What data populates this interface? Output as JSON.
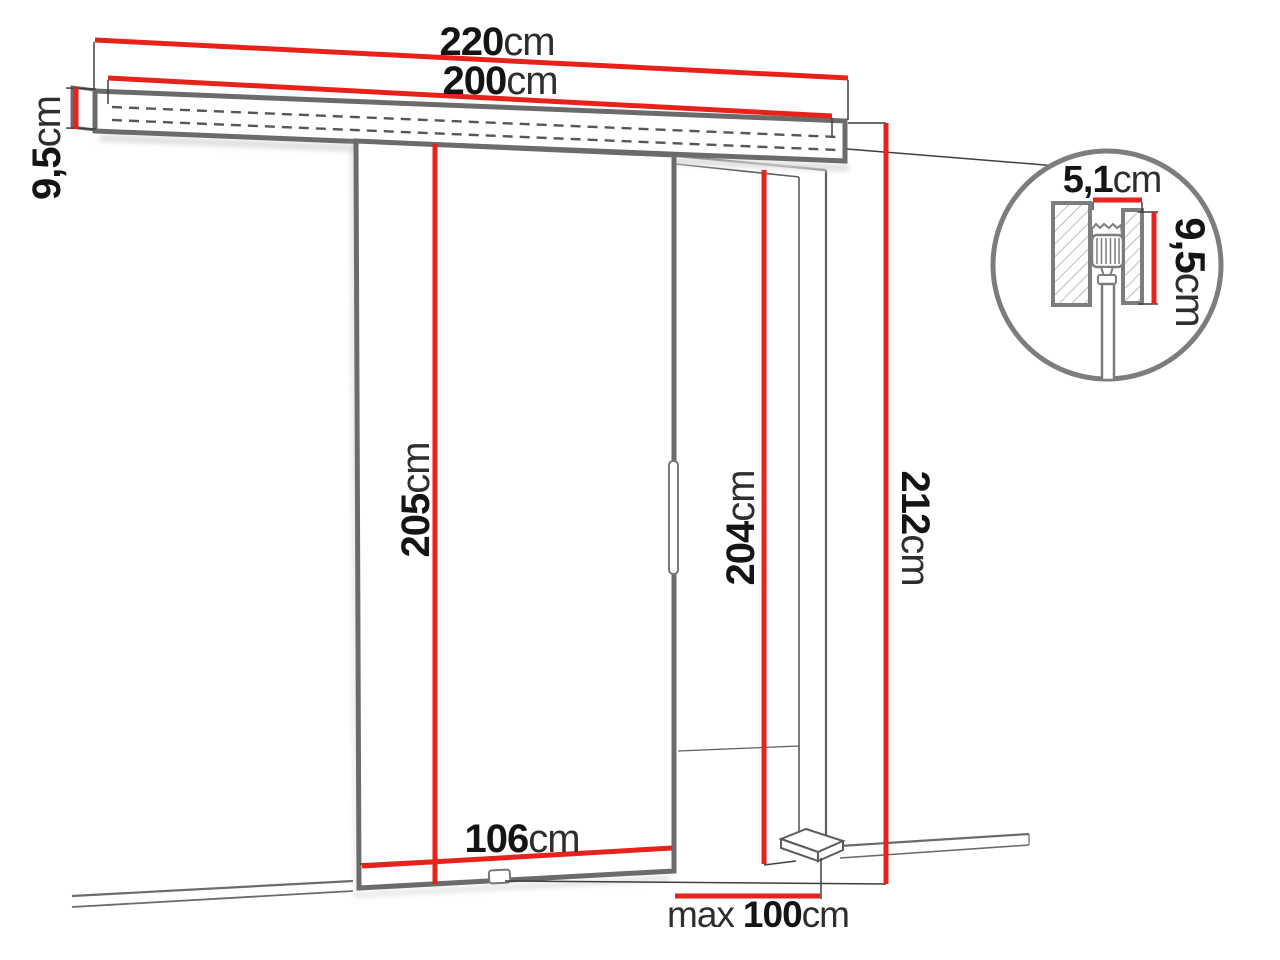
{
  "diagram": {
    "type": "sliding-door-dimension-drawing",
    "colors": {
      "dimension_red": "#e8211a",
      "structure_gray": "#6b6b6b",
      "thin_line_gray": "#3f3f3f",
      "detail_circle_gray": "#7d7d7d",
      "text_black": "#141414"
    },
    "dimensions": {
      "rail_total": {
        "value": "220",
        "unit": "cm"
      },
      "rail_track": {
        "value": "200",
        "unit": "cm"
      },
      "rail_height": {
        "value": "9,5",
        "unit": "cm"
      },
      "door_height": {
        "value": "205",
        "unit": "cm"
      },
      "opening_height": {
        "value": "204",
        "unit": "cm"
      },
      "overall_height": {
        "value": "212",
        "unit": "cm"
      },
      "door_width": {
        "value": "106",
        "unit": "cm"
      },
      "opening_width": {
        "prefix": "max",
        "value": "100",
        "unit": "cm"
      },
      "detail_depth": {
        "value": "5,1",
        "unit": "cm"
      },
      "detail_height": {
        "value": "9,5",
        "unit": "cm"
      }
    }
  }
}
